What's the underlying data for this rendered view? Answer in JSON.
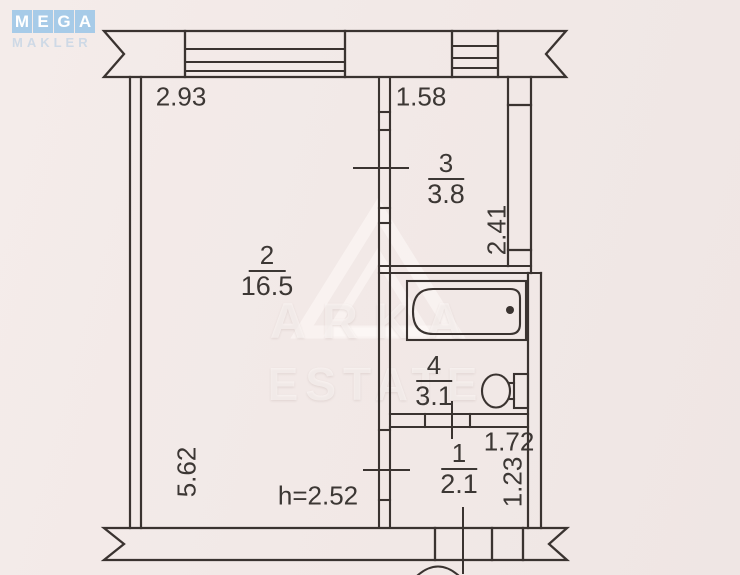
{
  "logo": {
    "letters": [
      "M",
      "E",
      "G",
      "A"
    ],
    "subtitle": "MAKLER",
    "tile_color": "#a7cbe8"
  },
  "watermark": {
    "line1": "ARKA",
    "line2": "ESTATE"
  },
  "rooms": [
    {
      "number": "2",
      "area": "16.5"
    },
    {
      "number": "3",
      "area": "3.8"
    },
    {
      "number": "4",
      "area": "3.1"
    },
    {
      "number": "1",
      "area": "2.1"
    }
  ],
  "dimensions": {
    "top_left_width": "2.93",
    "top_right_width": "1.58",
    "room3_depth": "2.41",
    "left_height": "5.62",
    "room1_width": "1.72",
    "room1_depth": "1.23",
    "ceiling_height": "h=2.52"
  },
  "fixtures": [
    {
      "icon": "bathtub-icon"
    },
    {
      "icon": "toilet-icon"
    }
  ],
  "colors": {
    "paper": "#f2e9e7",
    "line": "#3a3330",
    "text": "#3c3734",
    "logo_blue": "#a7cbe8",
    "watermark_white": "rgba(255,252,250,0.55)"
  }
}
